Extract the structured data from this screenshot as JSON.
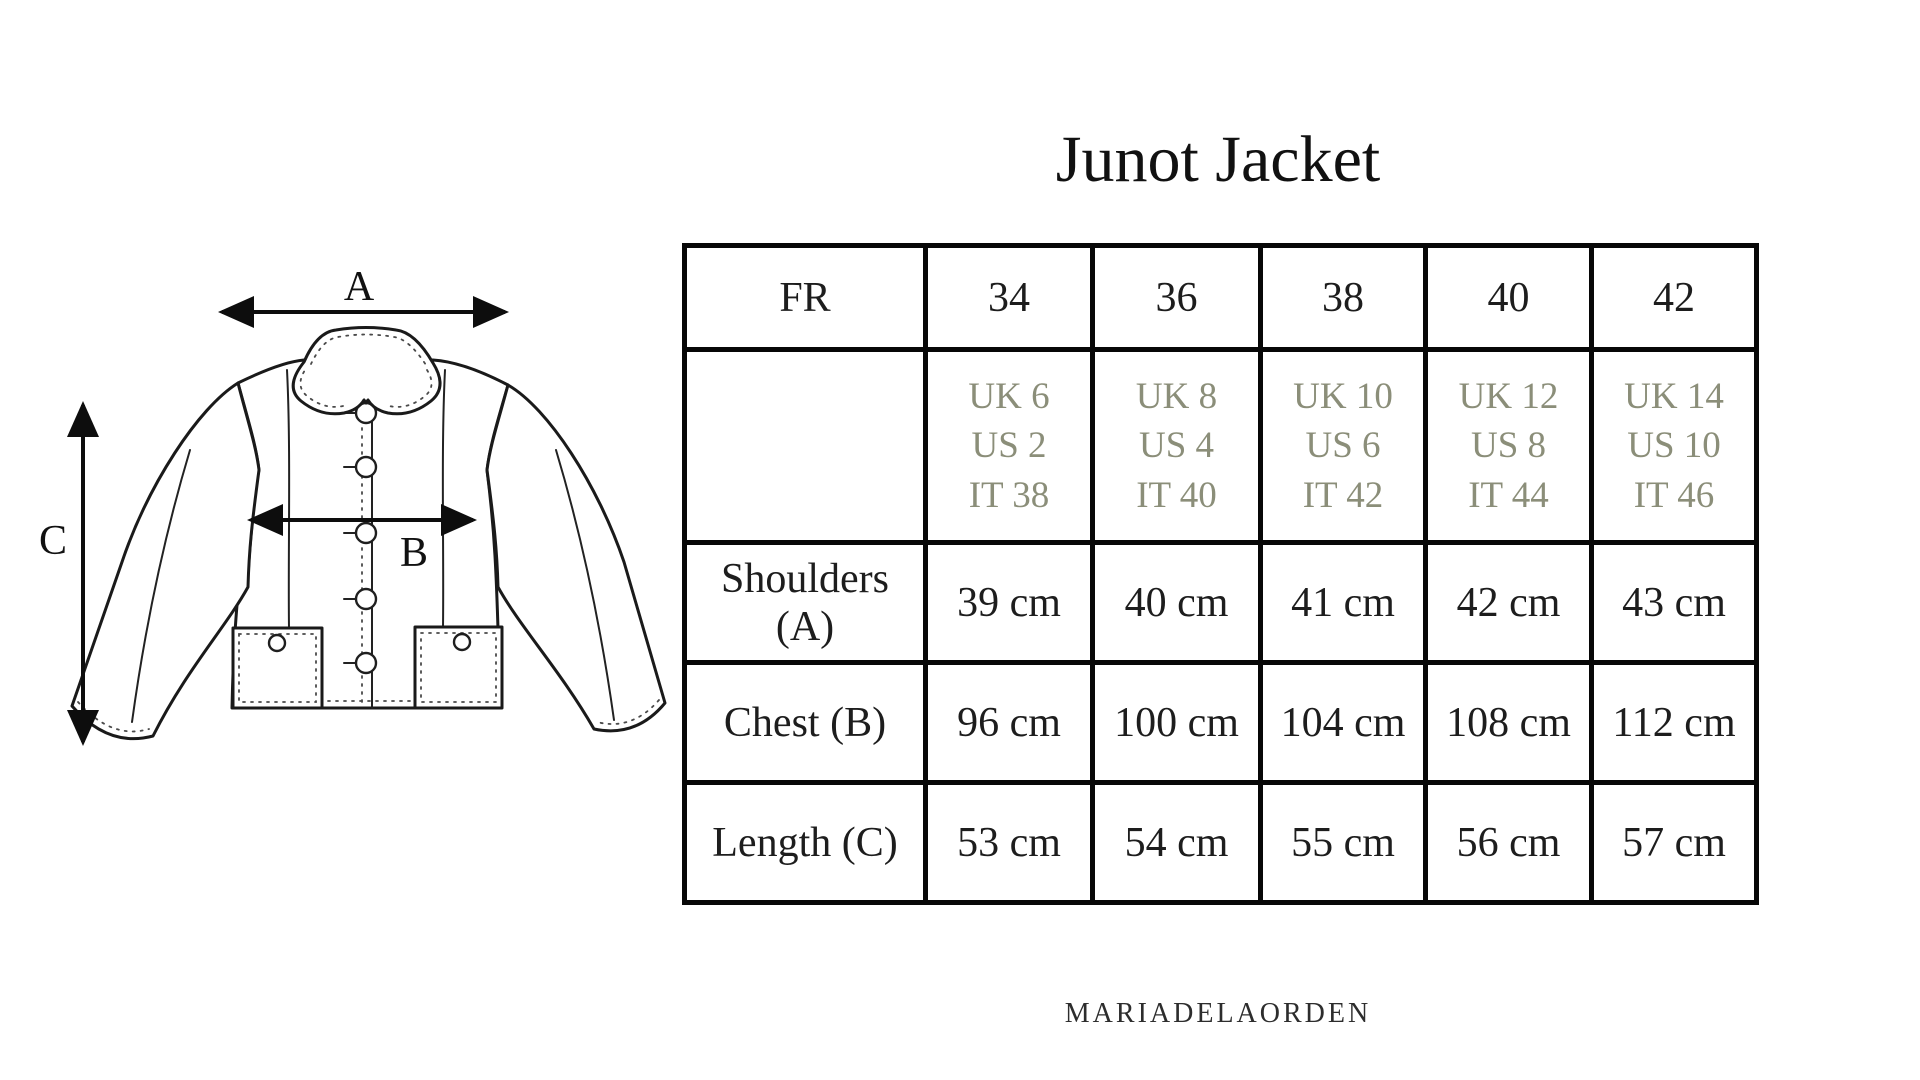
{
  "title": "Junot Jacket",
  "brand": "MARIADELAORDEN",
  "diagram": {
    "measure_labels": {
      "shoulders": "A",
      "chest": "B",
      "length": "C"
    }
  },
  "size_table": {
    "header_label": "FR",
    "sizes": [
      "34",
      "36",
      "38",
      "40",
      "42"
    ],
    "conversions": [
      [
        "UK 6",
        "US 2",
        "IT 38"
      ],
      [
        "UK 8",
        "US 4",
        "IT 40"
      ],
      [
        "UK 10",
        "US 6",
        "IT 42"
      ],
      [
        "UK 12",
        "US 8",
        "IT 44"
      ],
      [
        "UK 14",
        "US 10",
        "IT 46"
      ]
    ],
    "measurements": [
      {
        "label": "Shoulders (A)",
        "values": [
          "39 cm",
          "40 cm",
          "41 cm",
          "42 cm",
          "43 cm"
        ]
      },
      {
        "label": "Chest (B)",
        "values": [
          "96 cm",
          "100 cm",
          "104 cm",
          "108 cm",
          "112 cm"
        ]
      },
      {
        "label": "Length (C)",
        "values": [
          "53 cm",
          "54 cm",
          "55 cm",
          "56 cm",
          "57 cm"
        ]
      }
    ]
  },
  "colors": {
    "background": "#ffffff",
    "table_border": "#070707",
    "primary_text": "#1d1d1d",
    "conversion_text": "#8b8e79",
    "collar_inner_fill": "#d4d4d1"
  }
}
